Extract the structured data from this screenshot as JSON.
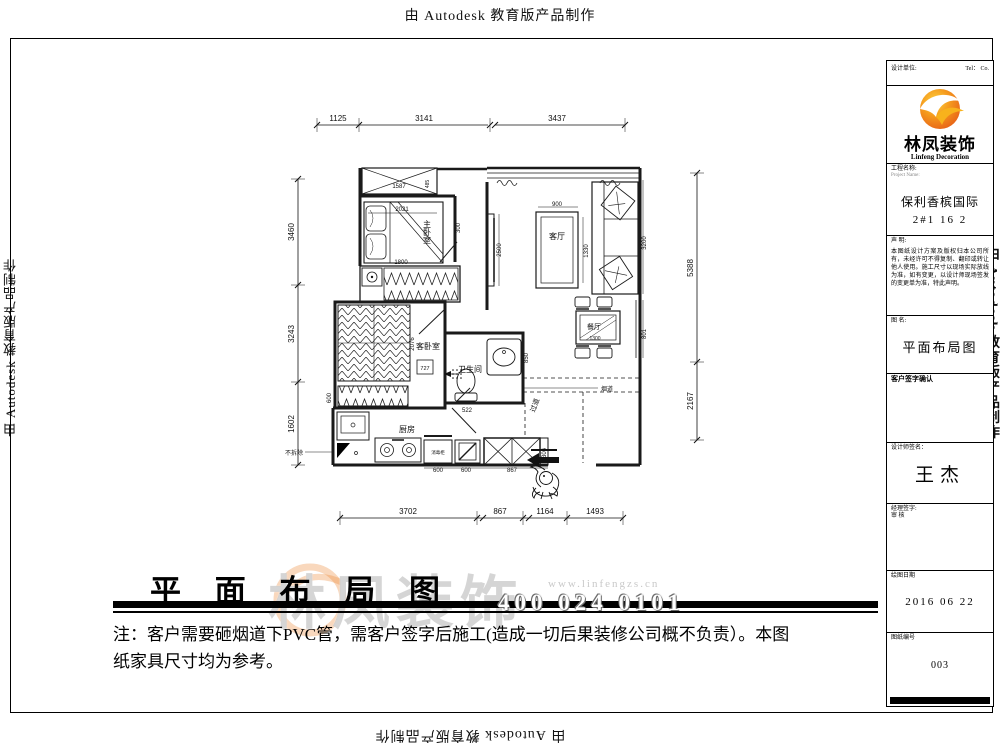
{
  "banner": {
    "text": "由 Autodesk 教育版产品制作"
  },
  "title": {
    "text": "平 面 布 局 图"
  },
  "watermark": {
    "brand": "林凤装饰",
    "phone": "400 024 0101",
    "url": "www.linfengzs.cn"
  },
  "note": {
    "line1": "注：客户需要砸烟道下PVC管，需客户签字后施工(造成一切后果装修公司概不负责）。本图",
    "line2": "纸家具尺寸均为参考。"
  },
  "rooms": {
    "master": "主卧室",
    "guest": "客卧室",
    "living": "客厅",
    "dining": "餐厅",
    "bath": "卫生间",
    "kitchen": "厨房"
  },
  "ann": {
    "no_demolish": "不拆除",
    "flue": "烟道",
    "hall": "过道",
    "cabinet": "消毒柜"
  },
  "dims": {
    "top": [
      "1125",
      "3141",
      "3437"
    ],
    "left": [
      "3460",
      "3243",
      "1602"
    ],
    "right": [
      "5388",
      "2167"
    ],
    "bottom": [
      "3702",
      "867",
      "1164",
      "1493"
    ],
    "bay": "1587",
    "bay_side": "485",
    "bed": "2021",
    "bed_side": "300",
    "wardrobe": "1800",
    "tv": "2500",
    "table_w": "900",
    "table_d": "1330",
    "sofa": "3200",
    "dining_side": "801",
    "dining_t": "1300",
    "guest_d": "2076",
    "guest_door": "727",
    "guest_w": "600",
    "basin": "850",
    "toilet": "522",
    "k1": "600",
    "k2": "600",
    "k3": "867",
    "k4": "306"
  },
  "titleblock": {
    "header_left": "设计单位:",
    "header_right": "Tel：  Co.",
    "brand": "林凤装饰",
    "brand_en": "Linfeng Decoration",
    "project_label": "工程名称:",
    "project_sub": "Project Name:",
    "project_name": "保利香槟国际",
    "project_unit": "2#1 16 2",
    "statement_label": "声  明:",
    "statement": "本图纸设计方案及版权归本公司所有，未经许可不得复制、翻印或转让他人使用。施工尺寸以现场实际放线为准，如有变更，以设计师现场签发的变更单为准，特此声明。",
    "drawing_label": "图  名:",
    "drawing_name": "平面布局图",
    "sign_label": "客户签字确认",
    "designer_label": "设计师签名：",
    "designer": "王杰",
    "review_label": "经理签字:",
    "review_label2": "审    核",
    "date_label": "绘图日期",
    "date": "2016 06 22",
    "no_label": "图纸编号",
    "no": "003"
  }
}
